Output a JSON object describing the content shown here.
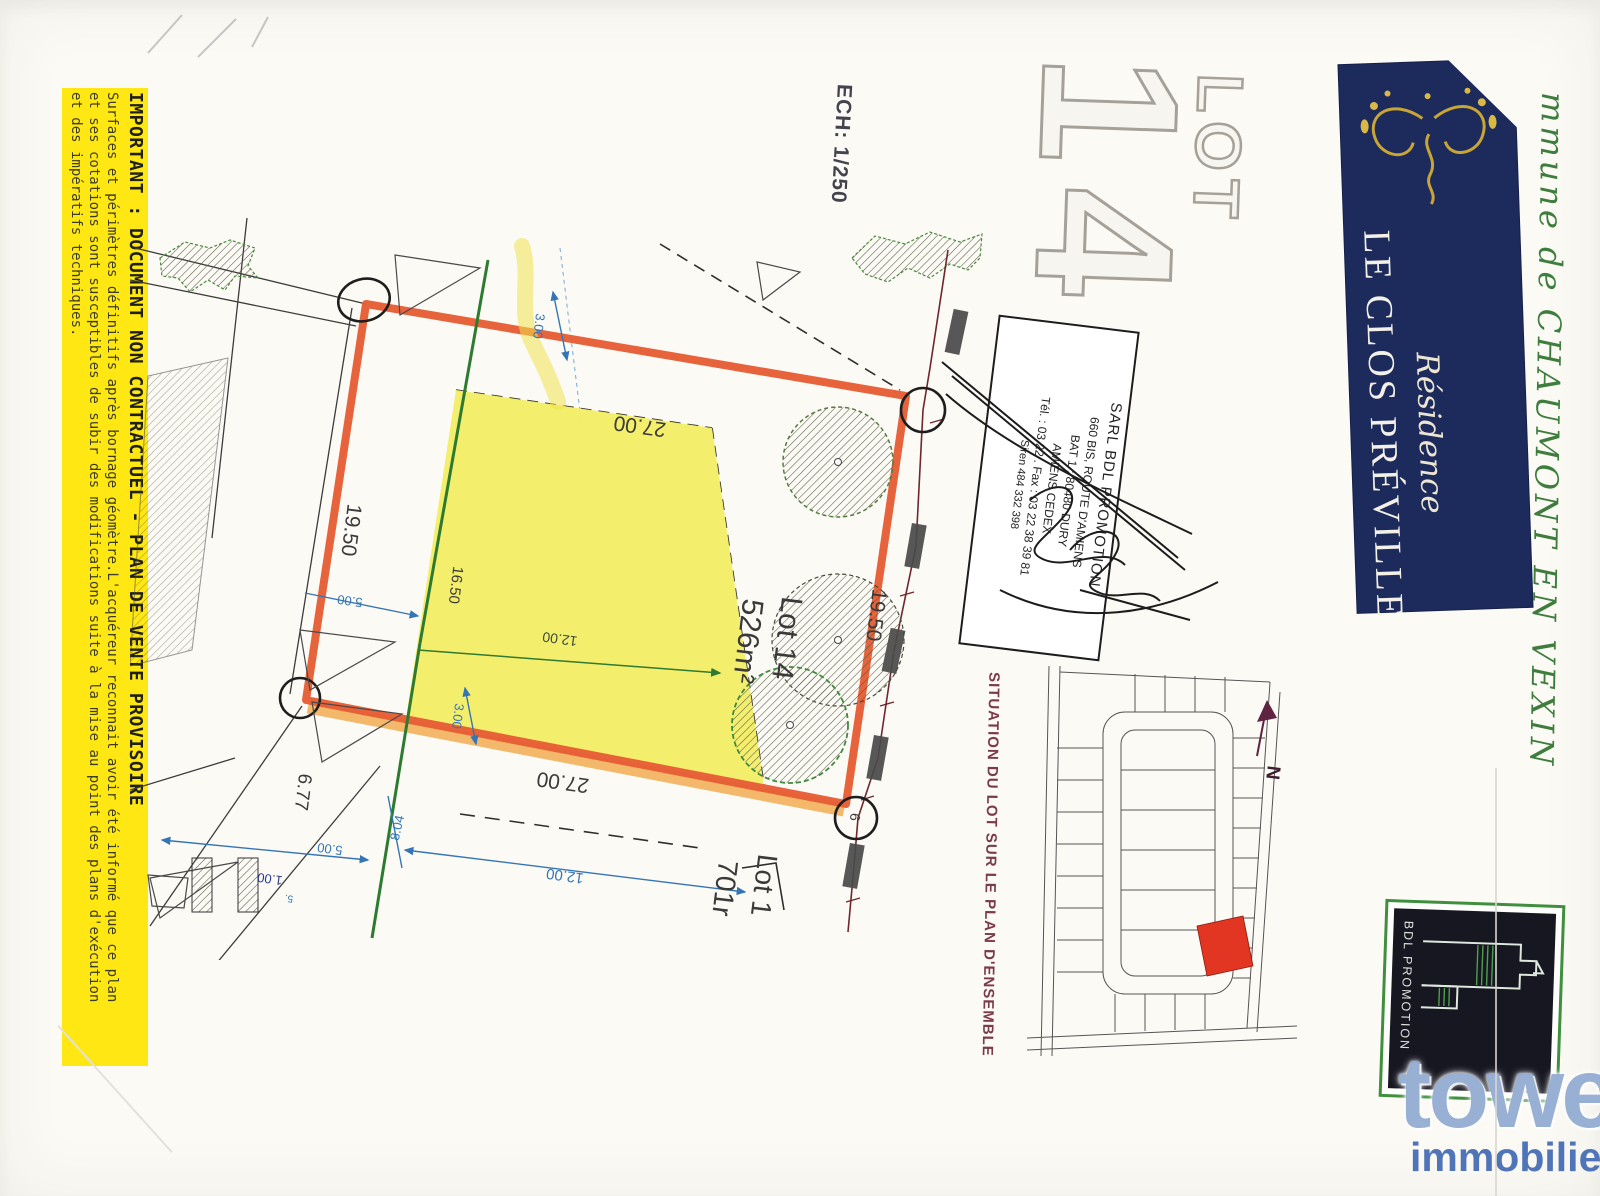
{
  "colors": {
    "banner_navy": "#1d2a5c",
    "boundary_orange": "#e65d34",
    "lot_fill_yellow": "#f4ed68",
    "highlight_red": "#e23522",
    "disclaimer_yellow": "#ffe714"
  },
  "disclaimer": {
    "line1": "IMPORTANT : DOCUMENT NON CONTRACTUEL - PLAN DE VENTE PROVISOIRE",
    "line2": "Surfaces et périmètres définitifs après bornage géomètre.L'acquéreur reconnait avoir été informé que ce plan",
    "line3": "et ses cotations sont susceptibles de subir des modifications suite à la mise au point des plans d'exécution",
    "line4": "et des impératifs techniques."
  },
  "plan": {
    "scale_label": "ECH: 1/250",
    "lot_word": "LOT",
    "lot_number": "14",
    "lot14": {
      "name": "Lot 14",
      "area": "526m²"
    },
    "lot1": {
      "name": "Lot 1",
      "area": "701r"
    },
    "corner_mark": "6",
    "dims": {
      "d27_top": "27.00",
      "d27_bottom": "27.00",
      "d1950_left": "19.50",
      "d1950_right": "19.50",
      "d1650": "16.50",
      "d1200_inner": "12.00",
      "d1200_outer": "12.00",
      "d300_top": "3.00",
      "d300_bottom": "3.00",
      "d500_mid": "5.00",
      "d500_bottom": "5.00",
      "d804": "8.04",
      "d677": "6.77",
      "d100": "1.00",
      "d5": "5."
    }
  },
  "banner": {
    "script": "Résidence",
    "name": "LE CLOS PRÉVILLE"
  },
  "commune_note": "mmune de CHAUMONT EN VEXIN",
  "stamp": {
    "line1": "SARL BDL PROMOTION",
    "line2": "660 BIS, ROUTE D'AMIENS",
    "line3": "BAT 1 : 80480 DURY",
    "line4": "AMIENS CEDEX",
    "line5": "Tél. : 03 22 . Fax : 03 22 38 39 81",
    "line6": "Siren 484 332 398"
  },
  "situation": {
    "label": "SITUATION DU LOT SUR LE PLAN D'ENSEMBLE",
    "north": "N"
  },
  "logos": {
    "bdl": "BDL PROMOTION",
    "tower": "tower",
    "tower_sub": "immobilier"
  }
}
